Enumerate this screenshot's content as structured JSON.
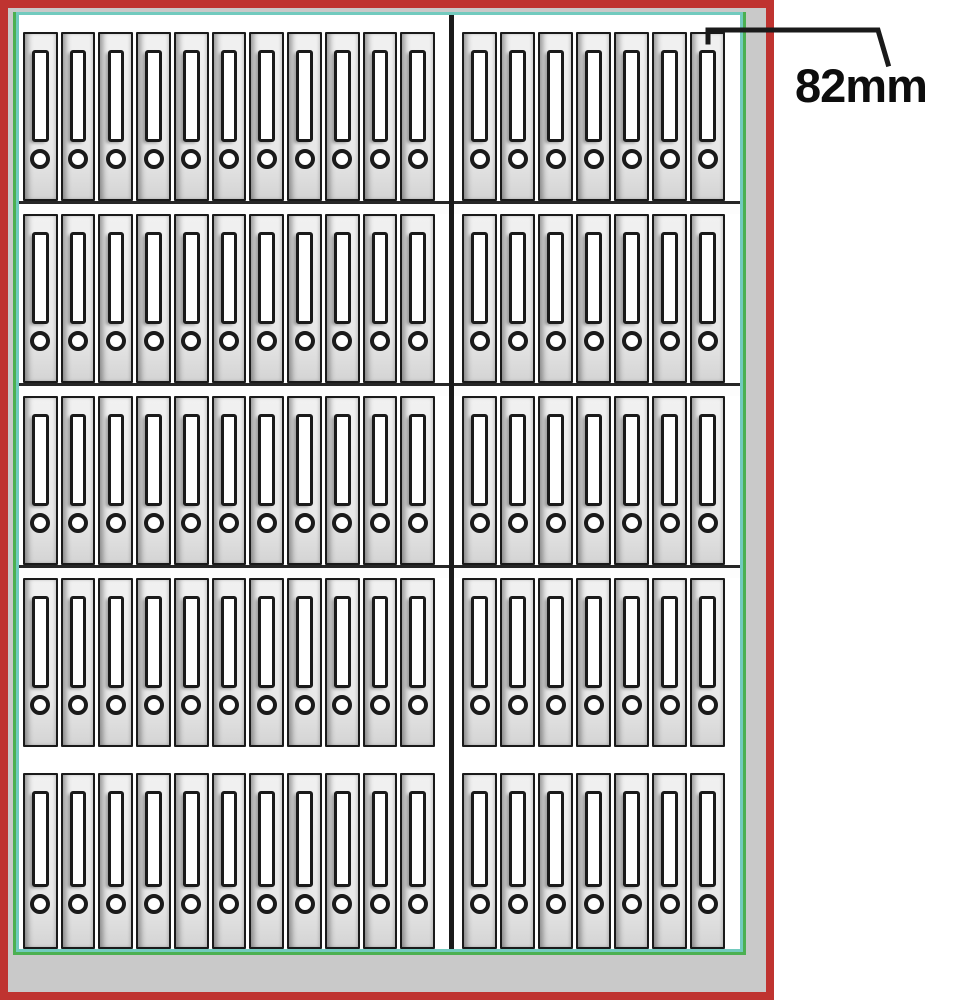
{
  "annotation": {
    "label": "82mm"
  },
  "cabinet": {
    "shelf_count": 5,
    "shelves": [
      {
        "left": 11,
        "right": 7
      },
      {
        "left": 11,
        "right": 7
      },
      {
        "left": 11,
        "right": 7
      },
      {
        "left": 11,
        "right": 7
      },
      {
        "left": 11,
        "right": 7
      }
    ],
    "binders_total": 90,
    "colors": {
      "outer_border": "#bf3330",
      "inner_frame_green": "#4cb051",
      "inner_frame_teal": "#72cabe",
      "plinth_gray": "#c9c9c9",
      "outline_black": "#1a1a1a",
      "binder_body": "#e8e8e8"
    }
  }
}
